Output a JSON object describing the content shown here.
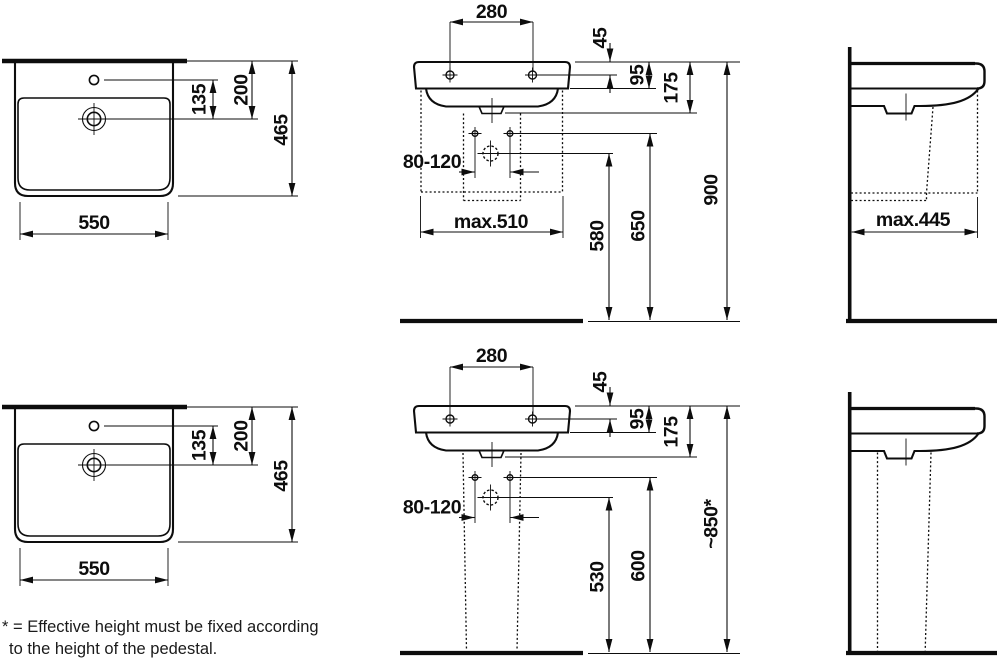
{
  "document": {
    "type": "washbasin installation drawing",
    "units": "mm",
    "line_color": "#0d0d0d",
    "background": "#ffffff"
  },
  "footnote": {
    "line1": "* = Effective height must be fixed according",
    "line2": "to the height of the pedestal."
  },
  "rows": {
    "wall_mounted": {
      "top_view": {
        "overflow_to_tap": "135",
        "back_to_tap": "200",
        "depth": "465",
        "width": "550"
      },
      "front_view": {
        "fixing_hole_spacing": "280",
        "rim_to_holes": "45",
        "rim_to_apron": "95",
        "rim_to_outlet": "175",
        "drain_offset_range": "80-120",
        "max_width": "max.510",
        "outlet_height": "580",
        "fixing_height": "650",
        "rim_height": "900"
      },
      "side_view": {
        "max_depth": "max.445"
      }
    },
    "with_pedestal": {
      "top_view": {
        "overflow_to_tap": "135",
        "back_to_tap": "200",
        "depth": "465",
        "width": "550"
      },
      "front_view": {
        "fixing_hole_spacing": "280",
        "rim_to_holes": "45",
        "rim_to_apron": "95",
        "rim_to_outlet": "175",
        "drain_offset_range": "80-120",
        "outlet_height": "530",
        "fixing_height": "600",
        "rim_height": "~850*"
      }
    }
  }
}
